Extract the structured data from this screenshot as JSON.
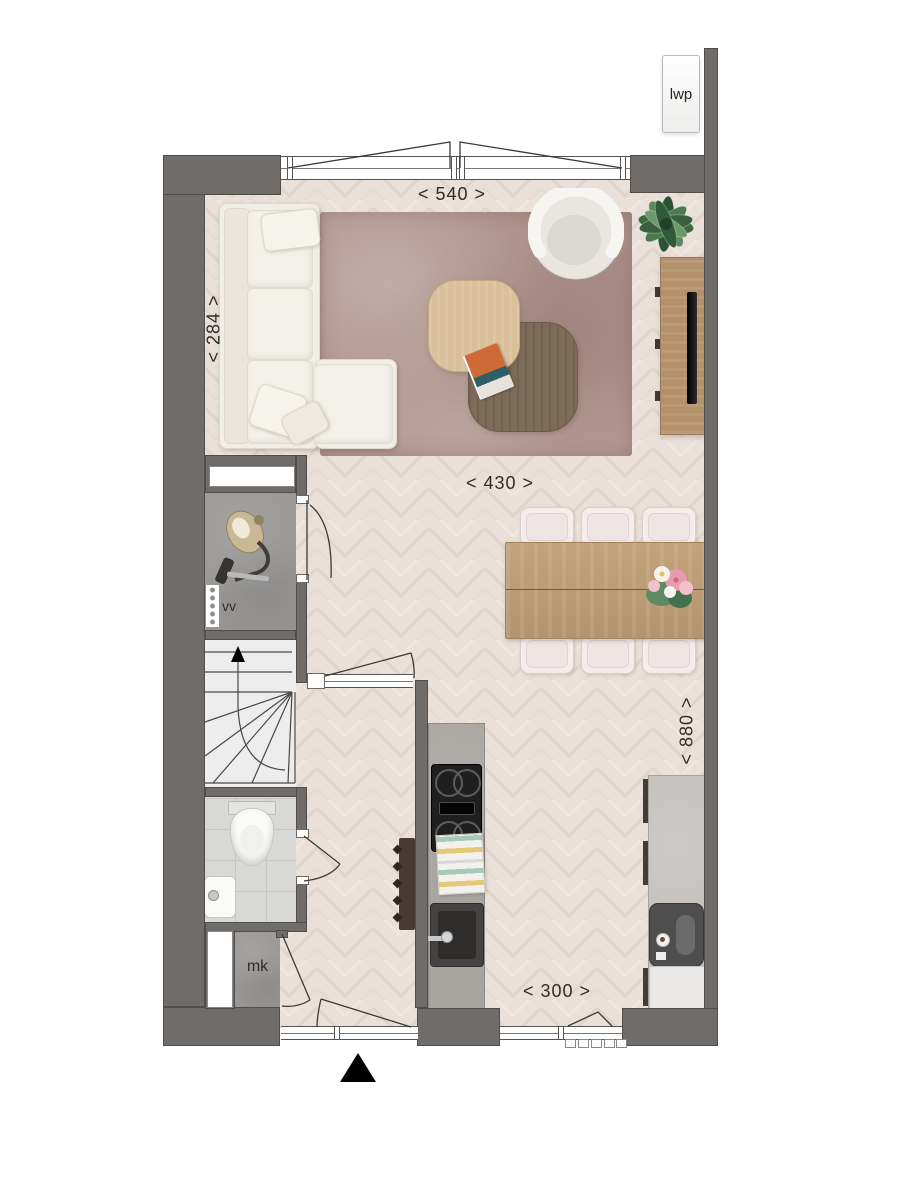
{
  "labels": {
    "heat_pump": "lwp",
    "meter_strip": "vv",
    "meter_cupboard": "mk"
  },
  "dimensions": {
    "top": "< 540 >",
    "left": "< 284 >",
    "middle": "< 430 >",
    "right": "< 880 >",
    "bottom": "< 300 >"
  },
  "colors": {
    "wall": "#6f6c6a",
    "floor": "#e8dfd8",
    "floorline": "#dbd0c8",
    "rug": "#b2978f",
    "concrete": "#9a9896",
    "tile": "#d8d9d7",
    "stairfloor": "#ecedec",
    "woodlight": "#d9c09b",
    "wooddark": "#7e6c59",
    "woodcab": "#b5916b",
    "counter1": "#a7a4a0",
    "counter2": "#c1beba",
    "sofa": "#f1eee7",
    "chair": "#f4edec",
    "labelc": "#2f2d2b"
  }
}
